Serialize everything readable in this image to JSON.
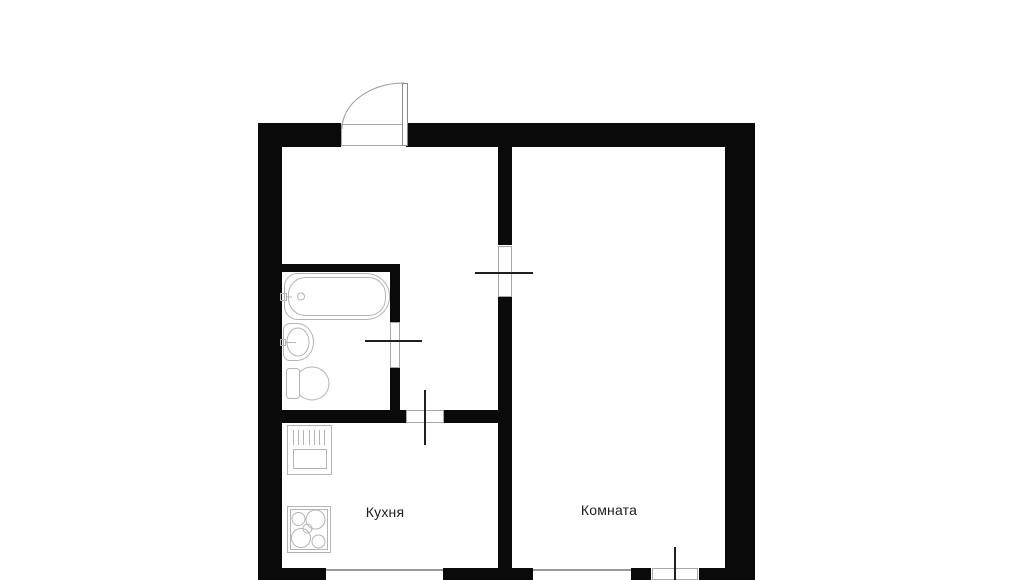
{
  "plan": {
    "title": "apartment-floor-plan",
    "rooms": {
      "kitchen": {
        "label": "Кухня"
      },
      "room": {
        "label": "Комната"
      }
    },
    "fixtures": [
      "entry-door-icon",
      "bathtub-icon",
      "wash-basin-icon",
      "toilet-icon",
      "kitchen-sink-unit-icon",
      "stove-icon",
      "kitchen-window",
      "room-window",
      "balcony-door"
    ],
    "colors": {
      "wall": "#0a0a0a",
      "fixture": "#b4b4b4",
      "jamb": "#a8a8a8",
      "marker": "#1f1f1f",
      "window": "#9a9a9a",
      "text": "#1c1c1c",
      "background": "#ffffff"
    }
  }
}
